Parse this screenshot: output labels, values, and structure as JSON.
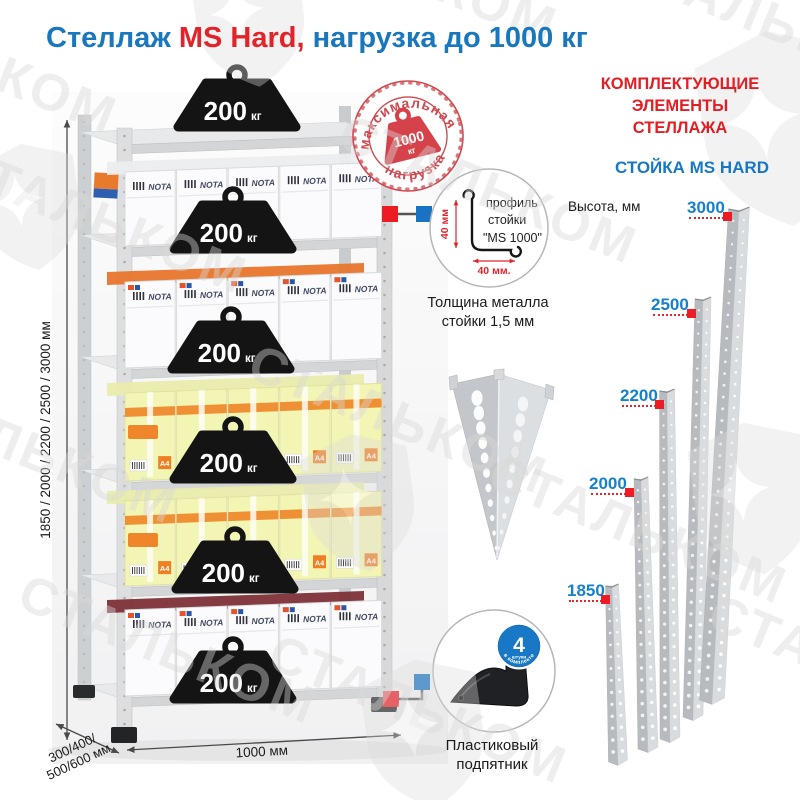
{
  "title": {
    "text_blue_1": "Стеллаж ",
    "text_red": "MS Hard,",
    "text_blue_2": " нагрузка до 1000 кг"
  },
  "stamp": {
    "arc_top": "максимальная",
    "arc_bottom": "нагрузка",
    "weight_value": "1000",
    "weight_unit": "кг"
  },
  "rack": {
    "weight_value": "200",
    "weight_unit": "кг",
    "weight_count": 6,
    "height_dim": "1850 / 2000 / 2200 / 2500 / 3000 мм",
    "depth_dim": [
      "300/400/",
      "500/600 мм"
    ],
    "width_dim": "1000 мм",
    "box_brand": "NOTA",
    "box_size_label": "A4"
  },
  "profile_detail": {
    "lines": [
      "профиль",
      "стойки",
      "\"MS 1000\""
    ],
    "dim_v": "40 мм",
    "dim_h": "40 мм.",
    "caption": [
      "Толщина металла",
      "стойки 1,5 мм"
    ]
  },
  "foot_detail": {
    "badge_number": "4",
    "badge_word": "штуки",
    "badge_arc": "в комплекте",
    "caption": [
      "Пластиковый",
      "подпятник"
    ]
  },
  "components": {
    "header": [
      "КОМПЛЕКТУЮЩИЕ",
      "ЭЛЕМЕНТЫ СТЕЛЛАЖА"
    ],
    "subheader": "СТОЙКА MS HARD",
    "height_label": "Высота, мм",
    "post_heights": [
      "3000",
      "2500",
      "2200",
      "2000",
      "1850"
    ]
  },
  "watermark": {
    "brand": "СТАЛЬКОМ"
  },
  "colors": {
    "blue": "#1877bd",
    "red": "#e31e24",
    "marker_red": "#ed1c24",
    "marker_blue": "#1873c4",
    "metal_light": "#d9dbdd",
    "metal_dark": "#b7babf"
  }
}
